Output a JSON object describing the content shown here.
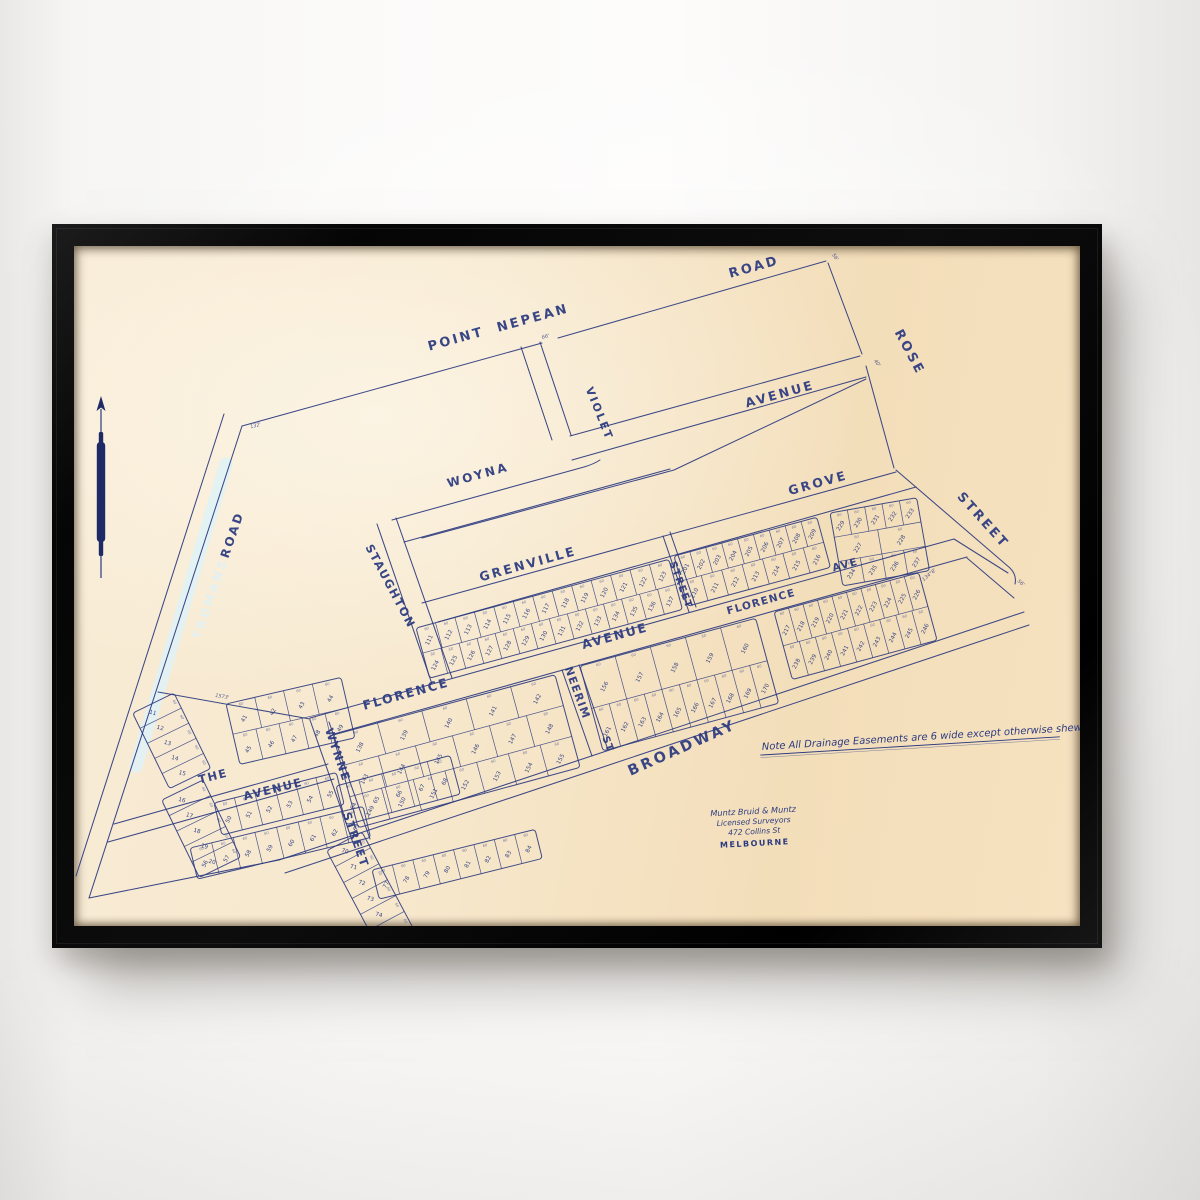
{
  "scene": {
    "wall_color": "#fbfaf9",
    "frame_color": "#0a0a0a",
    "paper_color": "#f7e8cd",
    "ink_color": "#2b3a80",
    "road_highlight_color": "#e2f1f3"
  },
  "map": {
    "note": "Note   All Drainage Easements are 6 wide except otherwise shewn",
    "surveyor": {
      "line1": "Muntz Bruid & Muntz",
      "line2": "Licensed Surveyors",
      "line3": "472 Collins St",
      "line4": "MELBOURNE"
    },
    "lot_width_label": "60",
    "north_arrow": "north-arrow",
    "street_labels": [
      {
        "t": "POINT",
        "x": 383,
        "y": 97,
        "r": -15.5,
        "s": 13,
        "ls": 2.5
      },
      {
        "t": "NEPEAN",
        "x": 460,
        "y": 76,
        "r": -15.5,
        "s": 13,
        "ls": 2.5
      },
      {
        "t": "ROAD",
        "x": 681,
        "y": 25,
        "r": -15.5,
        "s": 13,
        "ls": 2.5
      },
      {
        "t": "ROSE",
        "x": 832,
        "y": 108,
        "r": 62,
        "s": 13,
        "ls": 2.5
      },
      {
        "t": "STREET",
        "x": 906,
        "y": 277,
        "r": 48,
        "s": 13,
        "ls": 2.5
      },
      {
        "t": "AVENUE",
        "x": 707,
        "y": 152,
        "r": -15.5,
        "s": 12.5,
        "ls": 2.5
      },
      {
        "t": "VIOLET",
        "x": 522,
        "y": 169,
        "r": 68,
        "s": 11,
        "ls": 2
      },
      {
        "t": "WOYNA",
        "x": 405,
        "y": 233,
        "r": -15.5,
        "s": 12,
        "ls": 2.5
      },
      {
        "t": "STAUGHTON",
        "x": 313,
        "y": 342,
        "r": 62,
        "s": 11.5,
        "ls": 1.5
      },
      {
        "t": "TRUMANS",
        "x": 140,
        "y": 354,
        "r": -71,
        "s": 12,
        "ls": 2.5,
        "pale": true
      },
      {
        "t": "ROAD",
        "x": 162,
        "y": 290,
        "r": -71,
        "s": 12,
        "ls": 2.5
      },
      {
        "t": "GRENVILLE",
        "x": 455,
        "y": 322,
        "r": -15.5,
        "s": 12.5,
        "ls": 2.5
      },
      {
        "t": "GROVE",
        "x": 745,
        "y": 241,
        "r": -15.5,
        "s": 12.5,
        "ls": 2.5
      },
      {
        "t": "STREET",
        "x": 604,
        "y": 340,
        "r": 70,
        "s": 10,
        "ls": 1.2
      },
      {
        "t": "FLORENCE",
        "x": 333,
        "y": 452,
        "r": -15.5,
        "s": 12.5,
        "ls": 2
      },
      {
        "t": "AVENUE",
        "x": 542,
        "y": 394,
        "r": -15.5,
        "s": 12.5,
        "ls": 2
      },
      {
        "t": "FLORENCE",
        "x": 688,
        "y": 359,
        "r": -15.5,
        "s": 10.5,
        "ls": 1.2
      },
      {
        "t": "AVE",
        "x": 772,
        "y": 322,
        "r": -15.5,
        "s": 10.5,
        "ls": 1.2
      },
      {
        "t": "NEERIM",
        "x": 500,
        "y": 448,
        "r": 70,
        "s": 11,
        "ls": 1.2
      },
      {
        "t": "ST",
        "x": 531,
        "y": 499,
        "r": 70,
        "s": 10,
        "ls": 1
      },
      {
        "t": "WYNNE",
        "x": 260,
        "y": 510,
        "r": 71,
        "s": 11.5,
        "ls": 1.5
      },
      {
        "t": "STREET",
        "x": 278,
        "y": 595,
        "r": 71,
        "s": 11.5,
        "ls": 1.5
      },
      {
        "t": "THE",
        "x": 140,
        "y": 534,
        "r": -14,
        "s": 11.5,
        "ls": 1.5
      },
      {
        "t": "AVENUE",
        "x": 200,
        "y": 547,
        "r": -14,
        "s": 11.5,
        "ls": 1.5
      },
      {
        "t": "BROADWAY",
        "x": 610,
        "y": 506,
        "r": -24,
        "s": 14.5,
        "ls": 3
      }
    ],
    "ticks": [
      {
        "t": "132'",
        "x": 182,
        "y": 181,
        "r": -15
      },
      {
        "t": "66'",
        "x": 472,
        "y": 92,
        "r": -15
      },
      {
        "t": "56'",
        "x": 760,
        "y": 12,
        "r": 55
      },
      {
        "t": "40'",
        "x": 802,
        "y": 118,
        "r": 55
      },
      {
        "t": "56'",
        "x": 946,
        "y": 338,
        "r": 40
      },
      {
        "t": "1573'",
        "x": 148,
        "y": 452,
        "r": 9
      },
      {
        "t": "134°8'",
        "x": 856,
        "y": 330,
        "r": -40
      }
    ],
    "blocks": [
      {
        "x": 342,
        "y": 382,
        "a": -15.2,
        "len": 262,
        "d": 52,
        "rows": [
          [
            111,
            112,
            113,
            114,
            115,
            116,
            117,
            118,
            119,
            120,
            121,
            122,
            123
          ],
          [
            124,
            125,
            126,
            127,
            128,
            129,
            130,
            131,
            132,
            133,
            134,
            135,
            136,
            137
          ]
        ]
      },
      {
        "x": 600,
        "y": 310,
        "a": -15.2,
        "len": 148,
        "d": 52,
        "rows": [
          [
            201,
            202,
            203,
            204,
            205,
            206,
            207,
            208,
            209
          ],
          [
            210,
            211,
            212,
            213,
            214,
            215,
            216
          ]
        ]
      },
      {
        "x": 756,
        "y": 267,
        "a": -10,
        "len": 88,
        "d": 74,
        "rows": [
          [
            229,
            230,
            231,
            232,
            233
          ],
          [
            227,
            228
          ],
          [
            234,
            235,
            236,
            237
          ]
        ]
      },
      {
        "x": 259,
        "y": 489,
        "a": -15.2,
        "len": 230,
        "d": 96,
        "rows": [
          [
            138,
            139,
            140,
            141,
            142
          ],
          [
            143,
            144,
            145,
            146,
            147,
            148
          ],
          [
            149,
            150,
            151,
            152,
            153,
            154,
            155
          ]
        ]
      },
      {
        "x": 506,
        "y": 420,
        "a": -15.2,
        "len": 182,
        "d": 88,
        "rows": [
          [
            156,
            157,
            158,
            159,
            160
          ],
          [
            161,
            162,
            163,
            164,
            165,
            166,
            167,
            168,
            169,
            170
          ]
        ]
      },
      {
        "x": 700,
        "y": 366,
        "a": -15.2,
        "len": 150,
        "d": 70,
        "rows": [
          [
            217,
            218,
            219,
            220,
            221,
            222,
            223,
            224,
            225,
            226
          ],
          [
            238,
            239,
            240,
            241,
            242,
            243,
            244,
            245,
            246
          ]
        ]
      },
      {
        "x": 100,
        "y": 447,
        "a": 64,
        "len": 84,
        "d": 46,
        "rows": [
          [
            11,
            12,
            13,
            14,
            15
          ]
        ]
      },
      {
        "x": 129,
        "y": 534,
        "a": 64,
        "len": 86,
        "d": 46,
        "rows": [
          [
            16,
            17,
            18,
            19,
            20
          ]
        ]
      },
      {
        "x": 152,
        "y": 458,
        "a": -13,
        "len": 118,
        "d": 62,
        "rows": [
          [
            41,
            42,
            43,
            44
          ],
          [
            45,
            46,
            47,
            48,
            49
          ]
        ]
      },
      {
        "x": 140,
        "y": 557,
        "a": -14,
        "len": 126,
        "d": 33,
        "rows": [
          [
            50,
            51,
            52,
            53,
            54,
            55
          ]
        ]
      },
      {
        "x": 116,
        "y": 602,
        "a": -13.5,
        "len": 178,
        "d": 32,
        "rows": [
          [
            56,
            57,
            58,
            59,
            60,
            61,
            62,
            63
          ]
        ]
      },
      {
        "x": 262,
        "y": 540,
        "a": -15,
        "len": 118,
        "d": 40,
        "rows": [
          [
            64,
            65,
            66,
            67,
            68
          ]
        ]
      },
      {
        "x": 288,
        "y": 586,
        "a": 62,
        "len": 126,
        "d": 40,
        "rows": [
          [
            70,
            71,
            72,
            73,
            74,
            75,
            76
          ]
        ]
      },
      {
        "x": 298,
        "y": 624,
        "a": -14,
        "len": 168,
        "d": 30,
        "rows": [
          [
            77,
            78,
            79,
            80,
            81,
            82,
            83,
            84
          ]
        ]
      }
    ]
  }
}
